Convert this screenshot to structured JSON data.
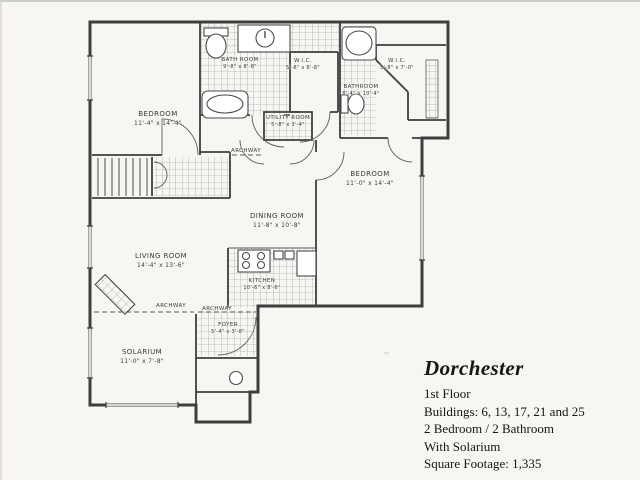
{
  "plan": {
    "rooms": [
      {
        "name": "BEDROOM",
        "dims": "11'-4\" x 14'-4\""
      },
      {
        "name": "BATH ROOM",
        "dims": "9'-8\" x 8'-8\""
      },
      {
        "name": "W.I.C.",
        "dims": "5'-8\" x 6'-8\""
      },
      {
        "name": "BATHROOM",
        "dims": "8'-4\" x 10'-4\""
      },
      {
        "name": "W.I.C.",
        "dims": "5'-8\" x 7'-0\""
      },
      {
        "name": "UTILITY ROOM",
        "dims": "5'-8\" x 3'-4\""
      },
      {
        "name": "BEDROOM",
        "dims": "11'-0\" x 14'-4\""
      },
      {
        "name": "DINING ROOM",
        "dims": "11'-8\" x 10'-8\""
      },
      {
        "name": "KITCHEN",
        "dims": "10'-6\" x 8'-6\""
      },
      {
        "name": "LIVING ROOM",
        "dims": "14'-4\" x 13'-6\""
      },
      {
        "name": "SOLARIUM",
        "dims": "11'-0\" x 7'-8\""
      },
      {
        "name": "FOYER",
        "dims": "5'-4\" x 3'-8\""
      }
    ],
    "annotations": {
      "archway": "ARCHWAY"
    }
  },
  "info": {
    "title": "Dorchester",
    "floor": "1st Floor",
    "buildings": "Buildings: 6, 13, 17, 21 and 25",
    "layout": "2 Bedroom / 2 Bathroom",
    "feature": "With Solarium",
    "sqft": "Square Footage: 1,335"
  }
}
